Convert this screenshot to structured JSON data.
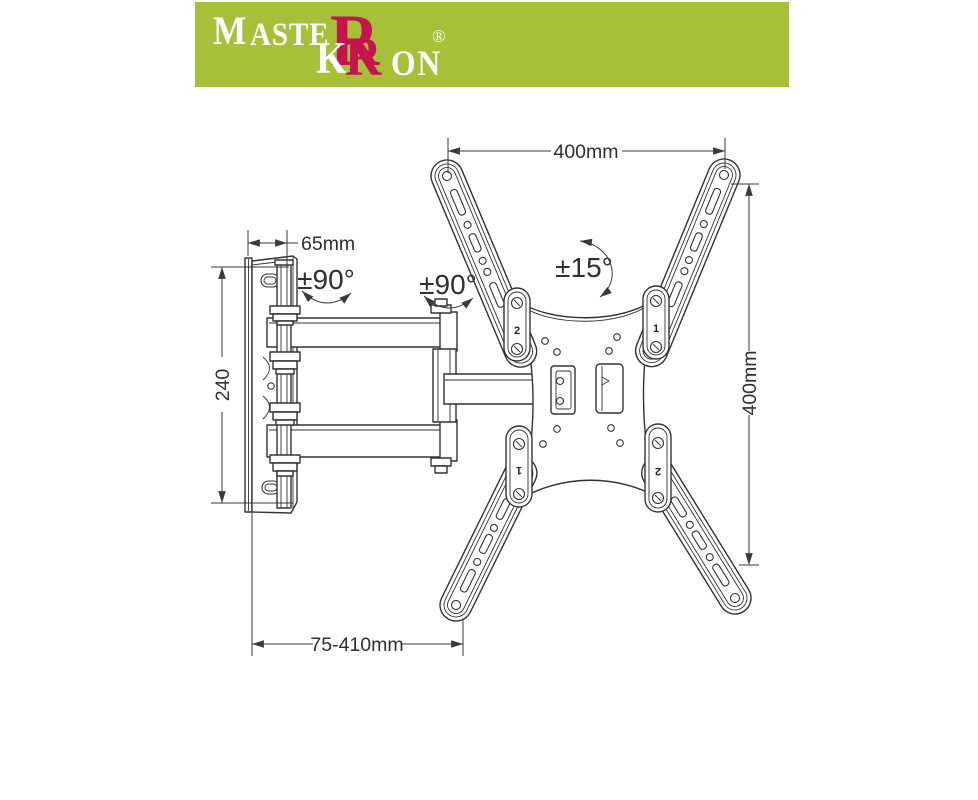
{
  "banner": {
    "brand_part1": "MASTE",
    "brand_r1": "R",
    "brand_part2_k": "K",
    "brand_r2": "R",
    "brand_part2_on": "ON",
    "registered_mark": "®",
    "background_color": "#a6c037",
    "accent_color": "#c4134f"
  },
  "diagram": {
    "dimensions": {
      "vesa_width": "400mm",
      "vesa_height": "400mm",
      "wall_plate_height": "240",
      "wall_plate_depth": "65mm",
      "extension_range": "75-410mm"
    },
    "angles": {
      "swivel_wall": "±90°",
      "swivel_arm": "±90°",
      "tilt": "±15°"
    },
    "arm_slot_labels": {
      "top_left": "2",
      "top_right": "1",
      "bottom_left": "1",
      "bottom_right": "2"
    },
    "line_color": "#3a3a3a"
  }
}
